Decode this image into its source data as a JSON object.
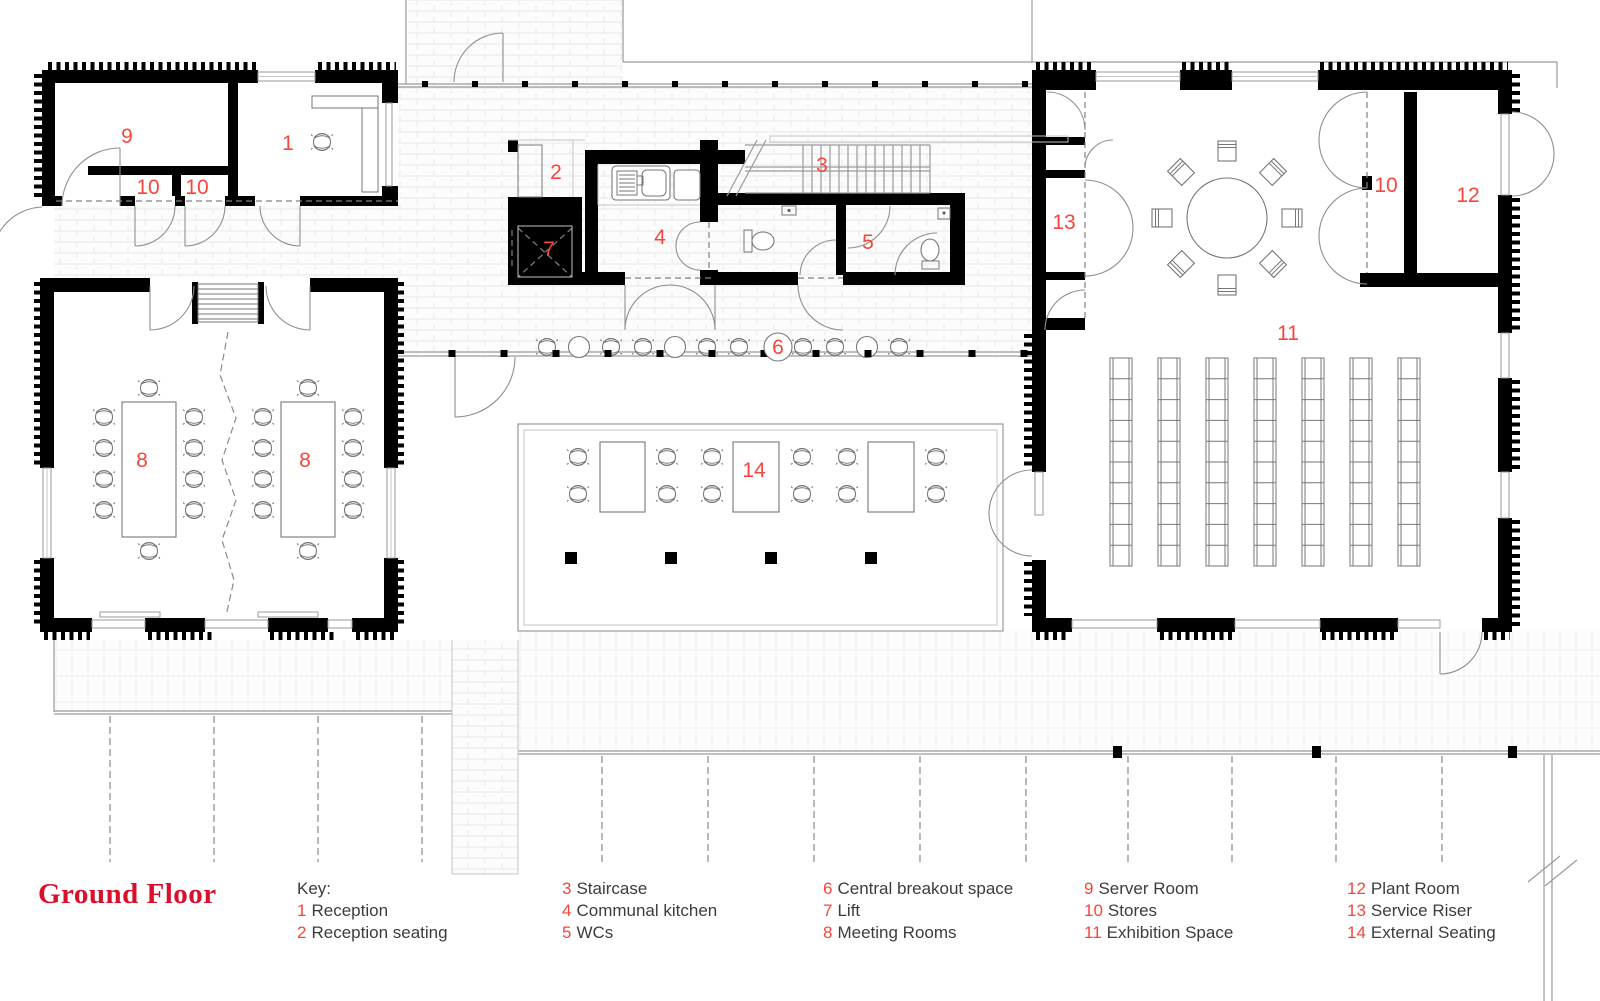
{
  "title": "Ground Floor",
  "colors": {
    "title_red": "#d8102c",
    "number_red": "#f4463c",
    "wall_black": "#000000"
  },
  "legend": {
    "heading": "Key:",
    "columns": [
      {
        "x": 297,
        "heading": "Key:",
        "items": [
          {
            "num": "1",
            "label": "Reception"
          },
          {
            "num": "2",
            "label": "Reception seating"
          }
        ]
      },
      {
        "x": 562,
        "items": [
          {
            "num": "3",
            "label": "Staircase"
          },
          {
            "num": "4",
            "label": "Communal kitchen"
          },
          {
            "num": "5",
            "label": "WCs"
          }
        ]
      },
      {
        "x": 823,
        "items": [
          {
            "num": "6",
            "label": "Central breakout space"
          },
          {
            "num": "7",
            "label": "Lift"
          },
          {
            "num": "8",
            "label": "Meeting Rooms"
          }
        ]
      },
      {
        "x": 1084,
        "items": [
          {
            "num": "9",
            "label": "Server Room"
          },
          {
            "num": "10",
            "label": "Stores"
          },
          {
            "num": "11",
            "label": "Exhibition Space"
          }
        ]
      },
      {
        "x": 1347,
        "items": [
          {
            "num": "12",
            "label": "Plant Room"
          },
          {
            "num": "13",
            "label": "Service Riser"
          },
          {
            "num": "14",
            "label": "External Seating"
          }
        ]
      }
    ]
  },
  "room_labels": [
    {
      "num": "1",
      "x": 288,
      "y": 150
    },
    {
      "num": "2",
      "x": 556,
      "y": 179
    },
    {
      "num": "3",
      "x": 822,
      "y": 172
    },
    {
      "num": "4",
      "x": 660,
      "y": 244
    },
    {
      "num": "5",
      "x": 868,
      "y": 249
    },
    {
      "num": "6",
      "x": 778,
      "y": 354,
      "circled": true
    },
    {
      "num": "7",
      "x": 549,
      "y": 256
    },
    {
      "num": "8",
      "x": 142,
      "y": 467
    },
    {
      "num": "8",
      "x": 305,
      "y": 467
    },
    {
      "num": "9",
      "x": 127,
      "y": 143
    },
    {
      "num": "10",
      "x": 148,
      "y": 194
    },
    {
      "num": "10",
      "x": 197,
      "y": 194
    },
    {
      "num": "10",
      "x": 1386,
      "y": 192
    },
    {
      "num": "11",
      "x": 1288,
      "y": 340
    },
    {
      "num": "12",
      "x": 1468,
      "y": 202
    },
    {
      "num": "13",
      "x": 1064,
      "y": 229
    },
    {
      "num": "14",
      "x": 754,
      "y": 477
    }
  ]
}
